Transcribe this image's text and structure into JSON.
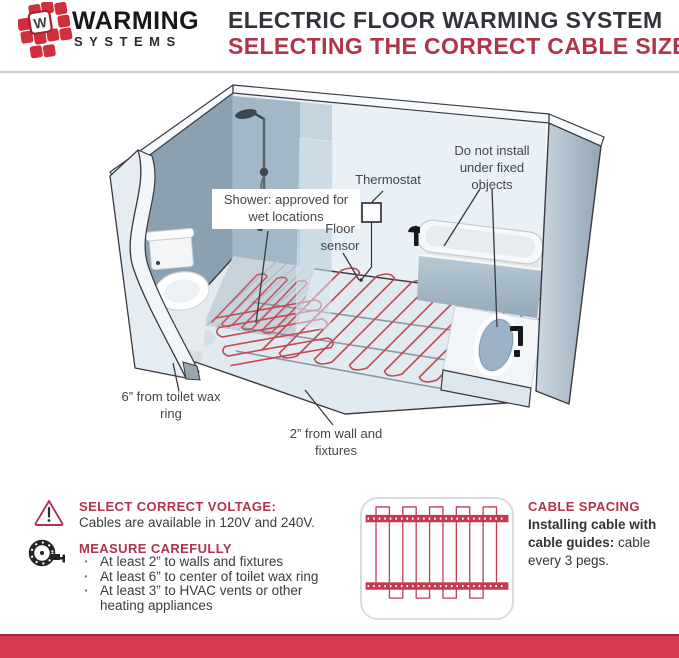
{
  "brand": {
    "logo_letter": "W",
    "name": "WARMING",
    "subname": "SYSTEMS"
  },
  "header": {
    "title": "ELECTRIC FLOOR WARMING SYSTEM",
    "subtitle": "SELECTING THE CORRECT CABLE SIZE"
  },
  "diagram": {
    "labels": {
      "shower": "Shower: approved for wet locations",
      "thermostat": "Thermostat",
      "floor_sensor": "Floor sensor",
      "fixed_objects": "Do not install under fixed objects",
      "toilet_clearance": "6” from toilet wax ring",
      "wall_clearance": "2” from wall and fixtures"
    }
  },
  "info": {
    "voltage": {
      "title": "SELECT CORRECT VOLTAGE:",
      "body": "Cables are available in 120V and 240V."
    },
    "measure": {
      "title": "MEASURE CAREFULLY",
      "bullets": [
        "At least 2” to walls and fixtures",
        "At least 6” to center of toilet wax ring",
        "At least 3” to HVAC vents or other heating appliances"
      ]
    },
    "spacing": {
      "title": "CABLE SPACING",
      "bold_text": "Installing cable with cable guides:",
      "regular_text": " cable every 3 pegs."
    }
  },
  "colors": {
    "accent_red": "#b23449",
    "footer_red": "#d43b52",
    "cable_red": "#c24a55",
    "logo_red": "#d02f3b",
    "text_dark": "#33333c",
    "label_gray": "#45454e",
    "divider_gray": "#cfcfcf"
  }
}
